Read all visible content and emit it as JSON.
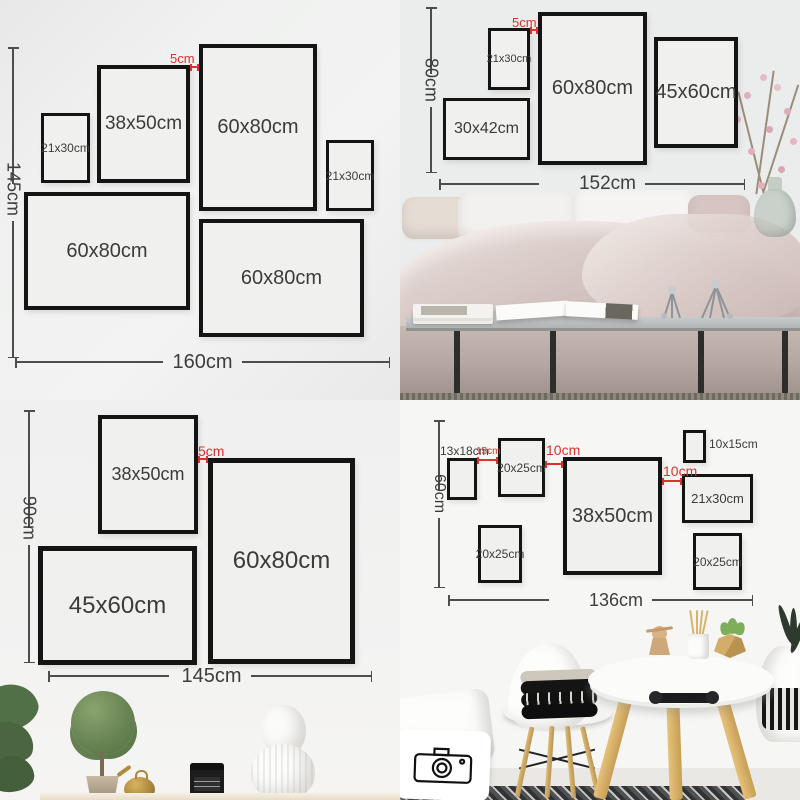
{
  "colors": {
    "accent_red": "#d9342c",
    "frame_border": "#141414",
    "frame_fill": "#f0f0ef",
    "dim_line": "#4d4d4d",
    "label_text": "#3b3b3b"
  },
  "quadrants": [
    {
      "id": "top-left",
      "frames": [
        {
          "label": "21x30cm",
          "x": 41,
          "y": 113,
          "w": 49,
          "h": 70,
          "bw": 3,
          "fs": 12
        },
        {
          "label": "38x50cm",
          "x": 97,
          "y": 65,
          "w": 93,
          "h": 118,
          "bw": 4,
          "fs": 19
        },
        {
          "label": "60x80cm",
          "x": 199,
          "y": 44,
          "w": 118,
          "h": 167,
          "bw": 4,
          "fs": 20
        },
        {
          "label": "21x30cm",
          "x": 326,
          "y": 140,
          "w": 48,
          "h": 71,
          "bw": 3,
          "fs": 12
        },
        {
          "label": "60x80cm",
          "x": 24,
          "y": 192,
          "w": 166,
          "h": 118,
          "bw": 4,
          "fs": 20
        },
        {
          "label": "60x80cm",
          "x": 199,
          "y": 219,
          "w": 165,
          "h": 118,
          "bw": 4,
          "fs": 20
        }
      ],
      "red_marks": [
        {
          "text": "5cm",
          "x": 170,
          "y": 51,
          "fs": 13,
          "line": {
            "x1": 190,
            "x2": 199,
            "y": 66
          }
        }
      ],
      "vdim": {
        "label": "145cm",
        "x": 12,
        "y1": 47,
        "y2": 358,
        "fs": 18,
        "mt": -22
      },
      "hdim": {
        "label": "160cm",
        "y": 362,
        "x1": 15,
        "x2": 390,
        "fs": 20,
        "ml": 0
      }
    },
    {
      "id": "top-right",
      "frames": [
        {
          "label": "21x30cm",
          "x": 88,
          "y": 28,
          "w": 42,
          "h": 62,
          "bw": 3,
          "fs": 11
        },
        {
          "label": "60x80cm",
          "x": 138,
          "y": 12,
          "w": 109,
          "h": 153,
          "bw": 4,
          "fs": 20
        },
        {
          "label": "45x60cm",
          "x": 254,
          "y": 37,
          "w": 84,
          "h": 111,
          "bw": 4,
          "fs": 20
        },
        {
          "label": "30x42cm",
          "x": 43,
          "y": 98,
          "w": 87,
          "h": 62,
          "bw": 3,
          "fs": 16
        }
      ],
      "red_marks": [
        {
          "text": "5cm",
          "x": 112,
          "y": 15,
          "fs": 13,
          "line": {
            "x1": 130,
            "x2": 138,
            "y": 29
          }
        }
      ],
      "vdim": {
        "label": "80cm",
        "x": 30,
        "y1": 7,
        "y2": 173,
        "fs": 18,
        "mt": -16
      },
      "hdim": {
        "label": "152cm",
        "y": 184,
        "x1": 39,
        "x2": 345,
        "fs": 19,
        "ml": 40
      }
    },
    {
      "id": "bottom-left",
      "frames": [
        {
          "label": "38x50cm",
          "x": 98,
          "y": 15,
          "w": 100,
          "h": 119,
          "bw": 4,
          "fs": 18
        },
        {
          "label": "60x80cm",
          "x": 208,
          "y": 58,
          "w": 147,
          "h": 206,
          "bw": 5,
          "fs": 24
        },
        {
          "label": "45x60cm",
          "x": 38,
          "y": 146,
          "w": 159,
          "h": 119,
          "bw": 5,
          "fs": 24
        }
      ],
      "red_marks": [
        {
          "text": "5cm",
          "x": 198,
          "y": 43,
          "fs": 14,
          "line": {
            "x1": 198,
            "x2": 208,
            "y": 58
          }
        }
      ],
      "vdim": {
        "label": "90cm",
        "x": 28,
        "y1": 10,
        "y2": 263,
        "fs": 18,
        "mt": -32
      },
      "hdim": {
        "label": "145cm",
        "y": 276,
        "x1": 48,
        "x2": 372,
        "fs": 20,
        "ml": 12
      }
    },
    {
      "id": "bottom-right",
      "frames": [
        {
          "label": "13x18cm",
          "x": 47,
          "y": 58,
          "w": 30,
          "h": 42,
          "bw": 3,
          "fs": 12,
          "label_pos": "above"
        },
        {
          "label": "20x25cm",
          "x": 98,
          "y": 38,
          "w": 47,
          "h": 59,
          "bw": 3,
          "fs": 12
        },
        {
          "label": "38x50cm",
          "x": 163,
          "y": 57,
          "w": 99,
          "h": 118,
          "bw": 4,
          "fs": 20
        },
        {
          "label": "10x15cm",
          "x": 283,
          "y": 30,
          "w": 23,
          "h": 33,
          "bw": 3,
          "fs": 12,
          "label_pos": "right"
        },
        {
          "label": "21x30cm",
          "x": 282,
          "y": 74,
          "w": 71,
          "h": 49,
          "bw": 3,
          "fs": 13
        },
        {
          "label": "20x25cm",
          "x": 293,
          "y": 133,
          "w": 49,
          "h": 57,
          "bw": 3,
          "fs": 12
        },
        {
          "label": "20x25cm",
          "x": 78,
          "y": 125,
          "w": 44,
          "h": 58,
          "bw": 3,
          "fs": 12
        }
      ],
      "red_marks": [
        {
          "text": "15cm",
          "x": 76,
          "y": 46,
          "fs": 10,
          "line": {
            "x1": 77,
            "x2": 98,
            "y": 59
          }
        },
        {
          "text": "10cm",
          "x": 146,
          "y": 42,
          "fs": 14,
          "line": {
            "x1": 145,
            "x2": 163,
            "y": 63
          }
        },
        {
          "text": "10cm",
          "x": 263,
          "y": 63,
          "fs": 14,
          "line": {
            "x1": 262,
            "x2": 282,
            "y": 80
          }
        }
      ],
      "vdim": {
        "label": "60cm",
        "x": 38,
        "y1": 20,
        "y2": 188,
        "fs": 16,
        "mt": -16
      },
      "hdim": {
        "label": "136cm",
        "y": 200,
        "x1": 48,
        "x2": 353,
        "fs": 18,
        "ml": 40
      }
    }
  ]
}
